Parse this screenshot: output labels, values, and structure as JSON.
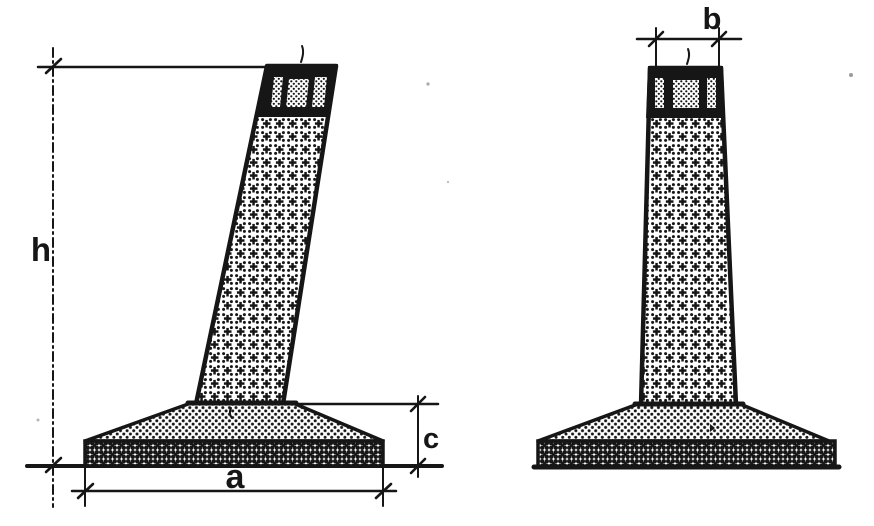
{
  "drawing": {
    "background_color": "#ffffff",
    "ink_color": "#161616",
    "views": {
      "front": {
        "dim_height": "h",
        "dim_base_width": "a",
        "dim_base_thickness": "c"
      },
      "side": {
        "dim_top_width": "b"
      }
    }
  }
}
